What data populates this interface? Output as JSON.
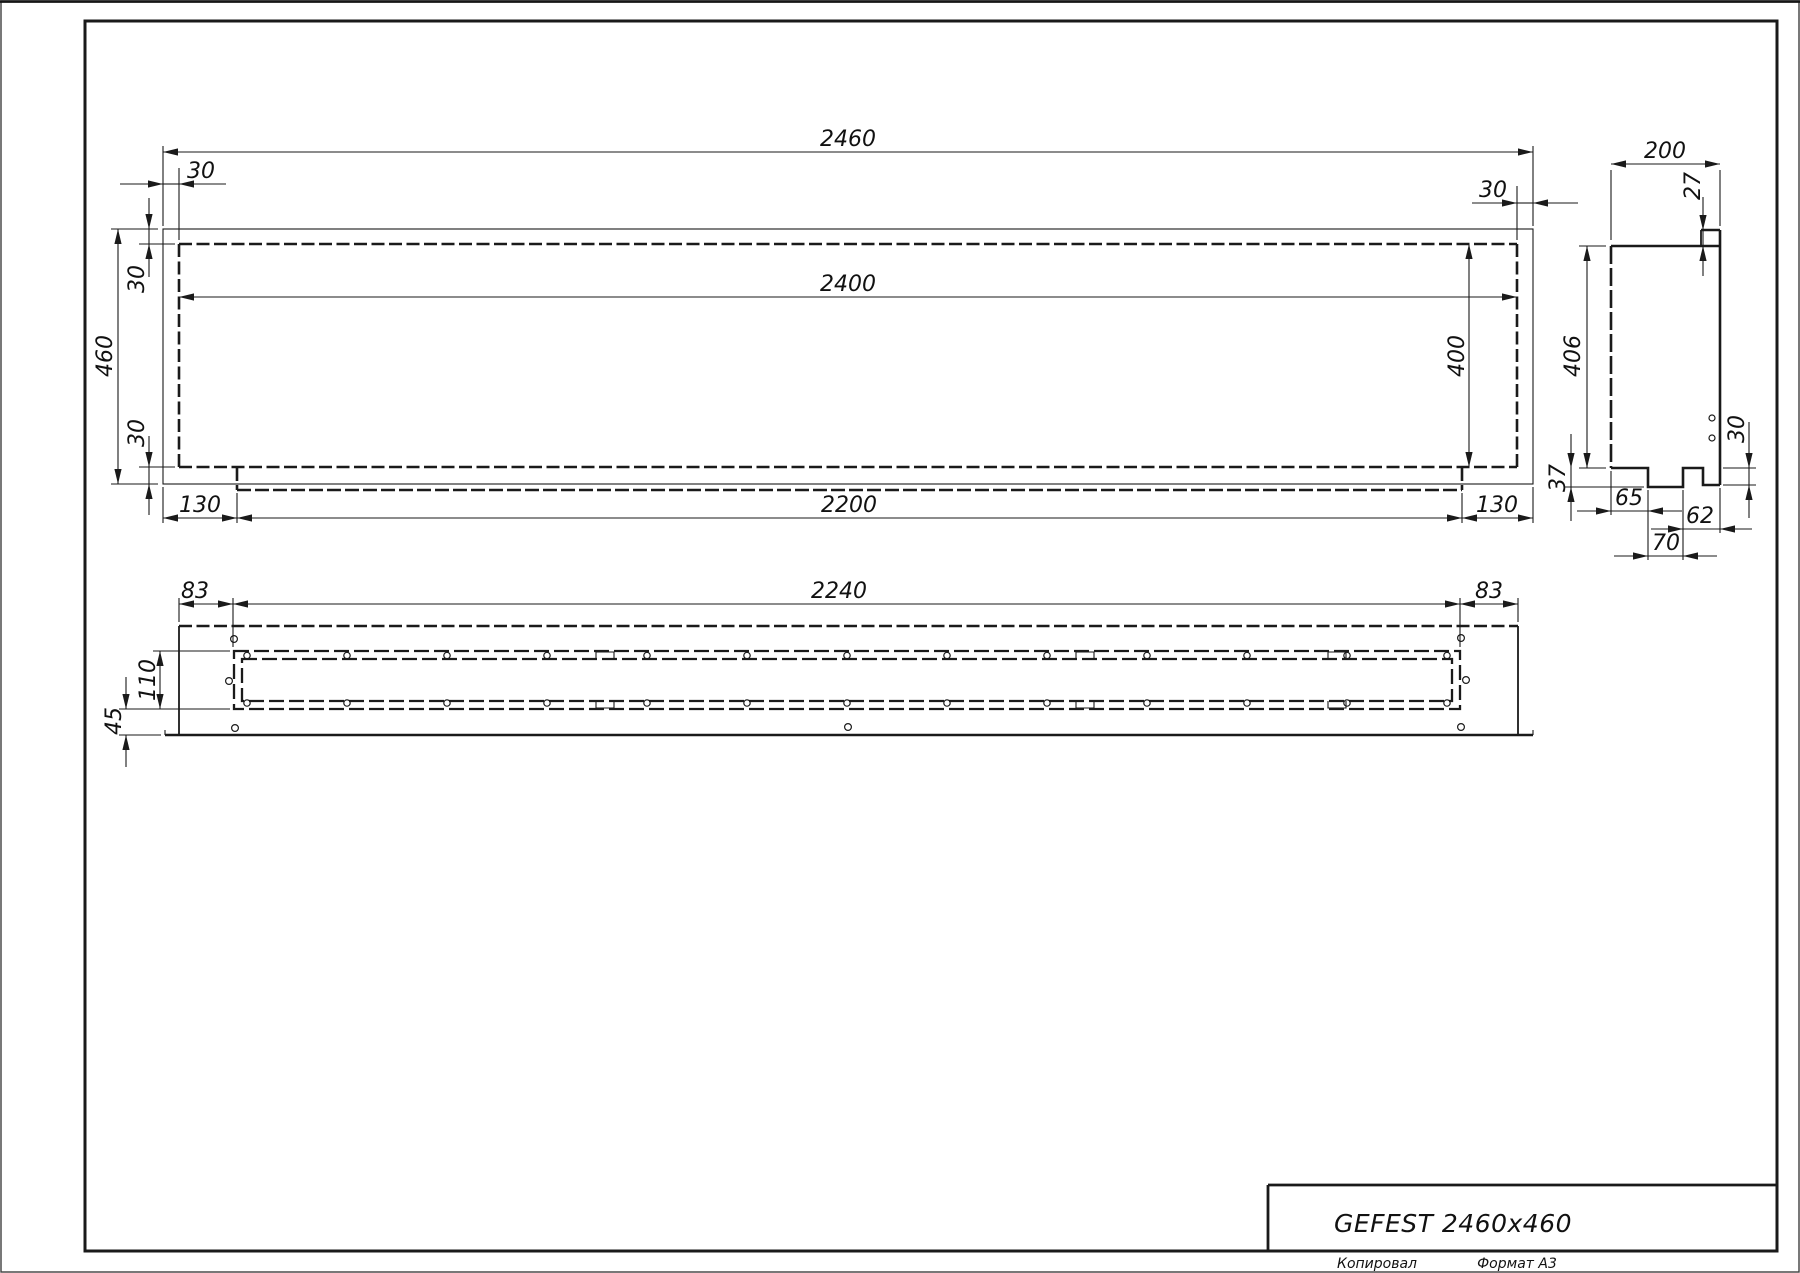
{
  "drawing": {
    "title": "GEFEST 2460x460",
    "footer": {
      "copied": "Копировал",
      "format": "Формат А3"
    }
  },
  "dims": {
    "front": {
      "total_width": "2460",
      "overhang_top_left": "30",
      "overhang_top_right": "30",
      "body_width": "2400",
      "total_height": "460",
      "side_top": "30",
      "side_bottom": "30",
      "bottom_left_offset": "130",
      "bottom_strip_width": "2200",
      "bottom_right_offset": "130",
      "body_height": "400"
    },
    "side": {
      "depth": "200",
      "lip_height": "27",
      "body_height": "406",
      "step_height": "37",
      "step_left_offset": "65",
      "step_right_offset": "62",
      "step_width": "70",
      "flange_drop": "30"
    },
    "plan": {
      "margin_left": "83",
      "slot_length": "2240",
      "margin_right": "83",
      "slot_width": "110",
      "front_offset": "45"
    }
  },
  "colors": {
    "line": "#1a1a1a",
    "background": "#ffffff"
  }
}
